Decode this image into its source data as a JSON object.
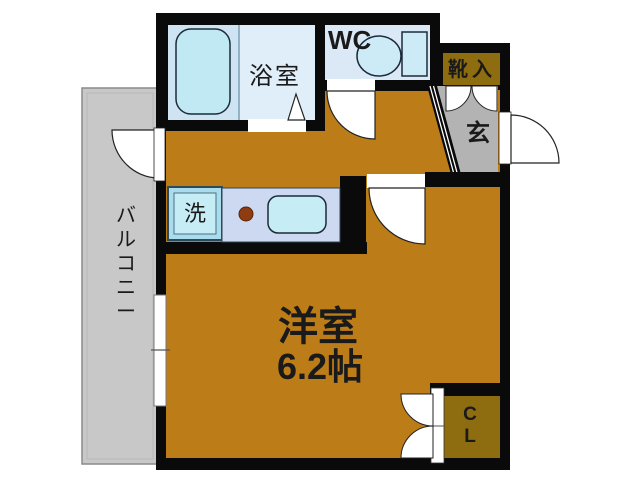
{
  "floorplan": {
    "labels": {
      "bathroom": "浴室",
      "wc": "WC",
      "shoe_cabinet": "靴入",
      "entrance": "玄",
      "balcony": "バルコニー",
      "laundry": "洗",
      "main_room": "洋室",
      "main_room_size": "6.2帖",
      "closet": "CL"
    },
    "colors": {
      "floor": "#bc7c18",
      "closet_floor": "#8e6c10",
      "shoe_floor": "#8e6c10",
      "wall": "#0a0a0a",
      "bath_floor_left": "#cfe4f2",
      "bath_floor_right": "#e0eef9",
      "bathtub": "#c0e9f3",
      "wc_floor": "#dbe9f6",
      "toilet": "#cdeaf7",
      "counter": "#ccd9f0",
      "sink": "#c6ecf6",
      "washer": "#c6ecf6",
      "washer_frame": "#a9dcec",
      "balcony": "#c8c8c8",
      "entrance_floor": "#b3b3b3",
      "burner": "#8f3c12"
    }
  }
}
